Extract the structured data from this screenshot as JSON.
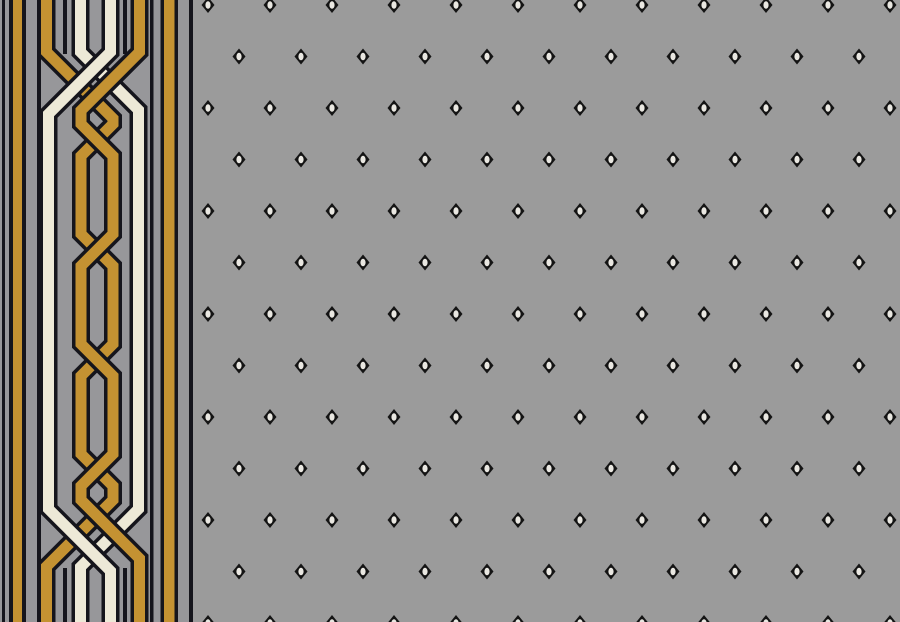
{
  "artwork": {
    "kind": "carpet-runner-pattern",
    "description": "Gray carpet field with staggered rows of small diamond motifs and a left border of interlaced gold and cream chain bands on a striped ground"
  },
  "palette": {
    "field_gray": "#9b9b9b",
    "border_gray": "#97979a",
    "gold": "#c49232",
    "cream": "#ede9d7",
    "dark": "#15151c",
    "diamond_dark": "#141414",
    "diamond_center": "#e9e7e1"
  },
  "canvas": {
    "width": 900,
    "height": 622
  },
  "border": {
    "width": 193,
    "stripes": [
      {
        "x": 2,
        "w": 3,
        "color": "dark"
      },
      {
        "x": 9,
        "w": 4,
        "color": "dark"
      },
      {
        "x": 13,
        "w": 9,
        "color": "gold"
      },
      {
        "x": 22,
        "w": 4,
        "color": "dark"
      },
      {
        "x": 37,
        "w": 4,
        "color": "dark"
      },
      {
        "x": 150,
        "w": 3.5,
        "color": "dark"
      },
      {
        "x": 160.5,
        "w": 3.5,
        "color": "dark"
      },
      {
        "x": 164,
        "w": 10.5,
        "color": "gold"
      },
      {
        "x": 174.5,
        "w": 3.5,
        "color": "dark"
      },
      {
        "x": 189,
        "w": 4,
        "color": "dark"
      }
    ],
    "band_width": 11,
    "band_outline_width": 18,
    "bands": [
      {
        "name": "chain-band-gold-a",
        "color": "gold",
        "path": "M 46.5,-2 V 52 L 113,118.5 V 124 L 81,156 V 234 L 113,266 V 344 L 81,376 V 454 L 113,486 V 500 L 46.5,566.5 V 624"
      },
      {
        "name": "chain-band-cream-a",
        "color": "cream",
        "path": "M 80.5,-2 V 52 L 138.5,110 V 509 L 80.5,567 V 624"
      },
      {
        "name": "chain-band-gold-b",
        "color": "gold",
        "path": "M 139.5,-2 V 52 L 81,110.5 V 124 L 113,156 V 234 L 81,266 V 344 L 113,376 V 454 L 81,486 V 500 L 139.5,558.5 V 624"
      },
      {
        "name": "chain-band-cream-b",
        "color": "cream",
        "path": "M 110.5,-2 V 52 L 48.5,114 V 509 L 110.5,571 V 624"
      }
    ],
    "stub_lines": [
      {
        "x": 65,
        "y1": 0,
        "y2": 54
      },
      {
        "x": 125,
        "y1": 0,
        "y2": 54
      },
      {
        "x": 65,
        "y1": 568,
        "y2": 622
      },
      {
        "x": 125,
        "y1": 568,
        "y2": 622
      }
    ],
    "stub_width": 4
  },
  "field": {
    "left": 193,
    "diamond": {
      "half_w": 6.5,
      "half_h": 8,
      "center_rx": 2.6,
      "center_ry": 3.8
    },
    "grid": {
      "first_row_y": 5,
      "row_spacing": 51.5,
      "rows": 13,
      "col_spacing": 62,
      "even_row_first_x": 208,
      "odd_row_first_x": 239,
      "right_limit": 897
    }
  }
}
